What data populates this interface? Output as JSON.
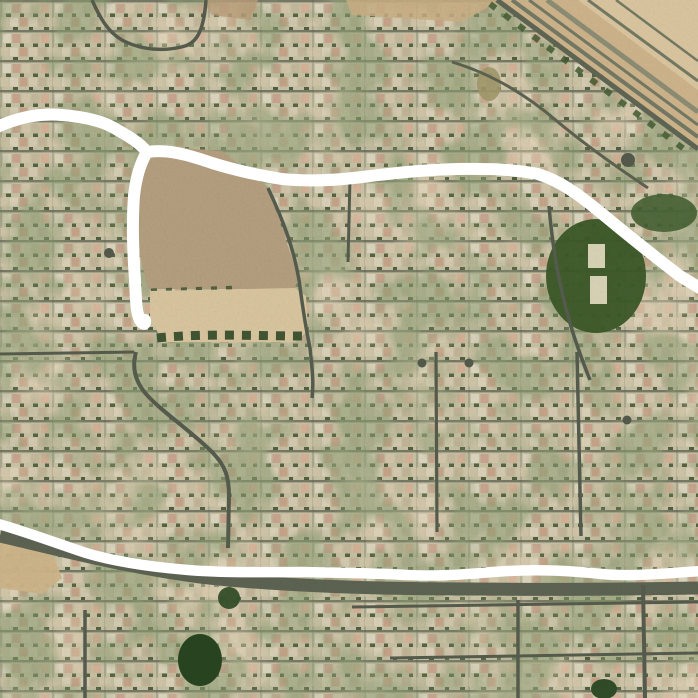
{
  "map": {
    "viewport": {
      "width": 698,
      "height": 698
    },
    "palette": {
      "terrain_base": "#c6bfa2",
      "street": "#4f5546",
      "dirt_lot": "#b29b7b",
      "sand": "#d9c59d",
      "corridor_tan": "#cdb287",
      "park_green": "#33511f",
      "route_annotation": "#ffffff"
    },
    "layers": [
      {
        "id": "base",
        "shapes": [
          {
            "type": "rect",
            "name": "terrain-base",
            "x": 0,
            "y": 0,
            "w": 698,
            "h": 698,
            "fill": "#c6bfa2"
          }
        ]
      },
      {
        "id": "landmarks",
        "shapes": [
          {
            "type": "polygon",
            "name": "rail-corridor",
            "points": "497,0 698,0 698,149",
            "fill": "#cdb287"
          },
          {
            "type": "polygon",
            "name": "rail-corridor-light",
            "points": "578,0 698,0 698,90",
            "fill": "#dcc69f",
            "opacity": 0.9
          },
          {
            "type": "polygon",
            "name": "top-dirt-strip",
            "points": "346,0 500,0 462,22 352,15",
            "fill": "#c9ab80",
            "opacity": 0.85
          },
          {
            "type": "polygon",
            "name": "top-dirt-patch",
            "points": "203,0 258,0 251,20 212,15",
            "fill": "#b89a74",
            "opacity": 0.8
          },
          {
            "type": "polygon",
            "name": "vacant-dirt-lot",
            "points": "152,156 170,147 222,151 268,187 298,276 295,289 148,289 139,252 137,204 144,168",
            "fill": "#b29b7b"
          },
          {
            "type": "path",
            "name": "dirt-lot-tree-row",
            "d": "M 151,291 L 240,288",
            "stroke": "#3f5130",
            "width": 5,
            "dash": "6 9",
            "opacity": 0.9
          },
          {
            "type": "polygon",
            "name": "sand-strip",
            "points": "150,291 295,288 306,296 308,331 295,342 163,342 150,318",
            "fill": "#d9c59d"
          },
          {
            "type": "path",
            "name": "sand-strip-tree-row",
            "d": "M 157,338 C 205,333 255,336 303,336",
            "stroke": "#2f4724",
            "width": 9,
            "dash": "9 8",
            "opacity": 0.95
          },
          {
            "type": "polygon",
            "name": "left-sand-patch",
            "points": "0,541 52,552 62,578 42,594 0,588",
            "fill": "#cdb286",
            "opacity": 0.95
          },
          {
            "type": "ellipse",
            "name": "park-lawn",
            "cx": 596,
            "cy": 276,
            "rx": 50,
            "ry": 57,
            "fill": "#33511f",
            "opacity": 0.96
          },
          {
            "type": "rect",
            "name": "sport-court-north",
            "x": 588,
            "y": 244,
            "w": 17,
            "h": 24,
            "fill": "#d8d2b5"
          },
          {
            "type": "rect",
            "name": "sport-court-south",
            "x": 590,
            "y": 276,
            "w": 17,
            "h": 28,
            "fill": "#d8d2b5"
          },
          {
            "type": "ellipse",
            "name": "tree-cluster-northeast",
            "cx": 664,
            "cy": 213,
            "rx": 33,
            "ry": 19,
            "fill": "#3c5a2a",
            "opacity": 0.9
          },
          {
            "type": "ellipse",
            "name": "tree-grove-bottom",
            "cx": 200,
            "cy": 660,
            "rx": 22,
            "ry": 26,
            "fill": "#1e3c17"
          },
          {
            "type": "ellipse",
            "name": "tree-grove-bottom-small",
            "cx": 229,
            "cy": 598,
            "rx": 11,
            "ry": 11,
            "fill": "#2a4720",
            "opacity": 0.95
          },
          {
            "type": "ellipse",
            "name": "tree-grove-bottom-right",
            "cx": 604,
            "cy": 689,
            "rx": 13,
            "ry": 10,
            "fill": "#274420"
          },
          {
            "type": "ellipse",
            "name": "dry-lawn-patch",
            "cx": 489,
            "cy": 84,
            "rx": 12,
            "ry": 17,
            "fill": "#9d9465",
            "opacity": 0.9
          }
        ]
      },
      {
        "id": "roads",
        "shapes": [
          {
            "type": "path",
            "name": "road-loop-northwest",
            "d": "M 92,0 C 100,18 108,32 122,40 C 140,50 165,52 185,46 C 198,42 204,28 206,0",
            "stroke": "#4f5546",
            "width": 3.5
          },
          {
            "type": "path",
            "name": "road-east-of-lot",
            "d": "M 268,188 C 284,222 294,250 299,280 C 303,310 306,330 310,348 C 312,368 314,382 312,398",
            "stroke": "#4f5546",
            "width": 3.5
          },
          {
            "type": "path",
            "name": "road-south-of-lot",
            "d": "M 136,352 C 132,366 134,380 146,394 C 162,412 190,430 212,452 C 226,466 229,478 229,496 L 228,548",
            "stroke": "#4f5546",
            "width": 4
          },
          {
            "type": "path",
            "name": "road-vertical-center",
            "d": "M 436,352 L 437,532",
            "stroke": "#4f5546",
            "width": 3.2
          },
          {
            "type": "path",
            "name": "road-vertical-east",
            "d": "M 577,352 L 581,536",
            "stroke": "#4f5546",
            "width": 3.5
          },
          {
            "type": "path",
            "name": "road-park-west",
            "d": "M 549,206 C 552,242 558,280 568,316 C 574,338 582,360 590,380",
            "stroke": "#4f5546",
            "width": 3.5
          },
          {
            "type": "path",
            "name": "road-vertical-north",
            "d": "M 350,178 L 348,262",
            "stroke": "#4f5546",
            "width": 3
          },
          {
            "type": "path",
            "name": "road-west-band",
            "d": "M 0,354 L 134,352",
            "stroke": "#4f5546",
            "width": 3
          },
          {
            "type": "path",
            "name": "corridor-frontage-road",
            "d": "M 497,0 L 698,149",
            "stroke": "#585e4c",
            "width": 5
          },
          {
            "type": "path",
            "name": "corridor-tree-line",
            "d": "M 490,4 L 688,152",
            "stroke": "#3a5229",
            "width": 6,
            "dash": "7 11",
            "opacity": 0.85
          },
          {
            "type": "path",
            "name": "rail-track-1",
            "d": "M 512,0 L 698,137",
            "stroke": "#6e735e",
            "width": 4
          },
          {
            "type": "path",
            "name": "rail-track-2",
            "d": "M 529,0 L 698,125",
            "stroke": "#6e735e",
            "width": 3
          },
          {
            "type": "path",
            "name": "rail-track-3",
            "d": "M 547,0 L 698,112",
            "stroke": "#87886f",
            "width": 5
          },
          {
            "type": "path",
            "name": "rail-track-4",
            "d": "M 588,0 L 698,81",
            "stroke": "#6e735e",
            "width": 3
          },
          {
            "type": "path",
            "name": "rail-track-5",
            "d": "M 616,0 L 698,61",
            "stroke": "#6e735e",
            "width": 2.5
          },
          {
            "type": "path",
            "name": "road-diagonal-northeast",
            "d": "M 452,62 C 492,74 528,96 558,122 C 588,147 618,168 648,188",
            "stroke": "#565b49",
            "width": 3
          },
          {
            "type": "path",
            "name": "road-bottom-arterial",
            "d": "M 0,536 C 60,550 130,568 200,577 C 280,586 380,589 470,589 C 560,590 640,589 698,588",
            "stroke": "#565c4b",
            "width": 13
          },
          {
            "type": "path",
            "name": "road-vertical-southeast",
            "d": "M 643,585 L 645,698",
            "stroke": "#4f5546",
            "width": 4
          },
          {
            "type": "path",
            "name": "road-vertical-south-center",
            "d": "M 518,600 L 518,698",
            "stroke": "#4f5546",
            "width": 3.5
          },
          {
            "type": "path",
            "name": "road-vertical-southwest",
            "d": "M 85,610 L 85,698",
            "stroke": "#4f5546",
            "width": 3.5
          },
          {
            "type": "path",
            "name": "road-horizontal-south-1",
            "d": "M 352,607 L 698,602",
            "stroke": "#4f5546",
            "width": 3
          },
          {
            "type": "path",
            "name": "road-horizontal-south-2",
            "d": "M 390,658 L 698,653",
            "stroke": "#4f5546",
            "width": 3
          }
        ]
      },
      {
        "id": "dots",
        "shapes": [
          {
            "type": "circle",
            "name": "cul-de-sac",
            "cx": 109,
            "cy": 253,
            "r": 5,
            "fill": "#4c5344"
          },
          {
            "type": "circle",
            "name": "cul-de-sac",
            "cx": 628,
            "cy": 160,
            "r": 7,
            "fill": "#4c5344"
          },
          {
            "type": "circle",
            "name": "cul-de-sac",
            "cx": 422,
            "cy": 363,
            "r": 4.5,
            "fill": "#4c5344"
          },
          {
            "type": "circle",
            "name": "cul-de-sac",
            "cx": 469,
            "cy": 363,
            "r": 4.5,
            "fill": "#4c5344"
          },
          {
            "type": "circle",
            "name": "cul-de-sac",
            "cx": 627,
            "cy": 420,
            "r": 4.5,
            "fill": "#4c5344"
          }
        ]
      },
      {
        "id": "annotations",
        "shapes": [
          {
            "type": "path",
            "name": "route-line-west",
            "d": "M -5,128 C 18,117 40,113 62,115 C 86,117 102,121 114,128 C 130,137 140,143 147,152 C 141,162 136,177 134,196 C 132,222 133,252 135,280 C 136,300 136,312 140,320 C 143,325 146,325 145,320",
            "stroke": "#ffffff",
            "width": 12,
            "cap": "round"
          },
          {
            "type": "path",
            "name": "route-line-north",
            "d": "M 147,152 C 166,149 186,154 212,163 C 238,171 258,175 282,179 C 312,182 338,180 362,177 C 402,172 442,168 482,169 C 502,169 522,171 538,174 C 560,181 578,194 600,212 C 624,232 654,256 680,276 L 703,290",
            "stroke": "#ffffff",
            "width": 12,
            "cap": "round"
          },
          {
            "type": "path",
            "name": "route-line-south",
            "d": "M -5,523 C 24,531 56,543 86,553 C 116,562 152,567 188,570 C 224,573 264,572 304,572 C 344,573 376,573 406,575 C 446,577 476,573 508,571 C 542,569 572,571 602,574 C 632,577 668,573 703,571",
            "stroke": "#ffffff",
            "width": 10.5,
            "cap": "round"
          }
        ]
      }
    ]
  }
}
